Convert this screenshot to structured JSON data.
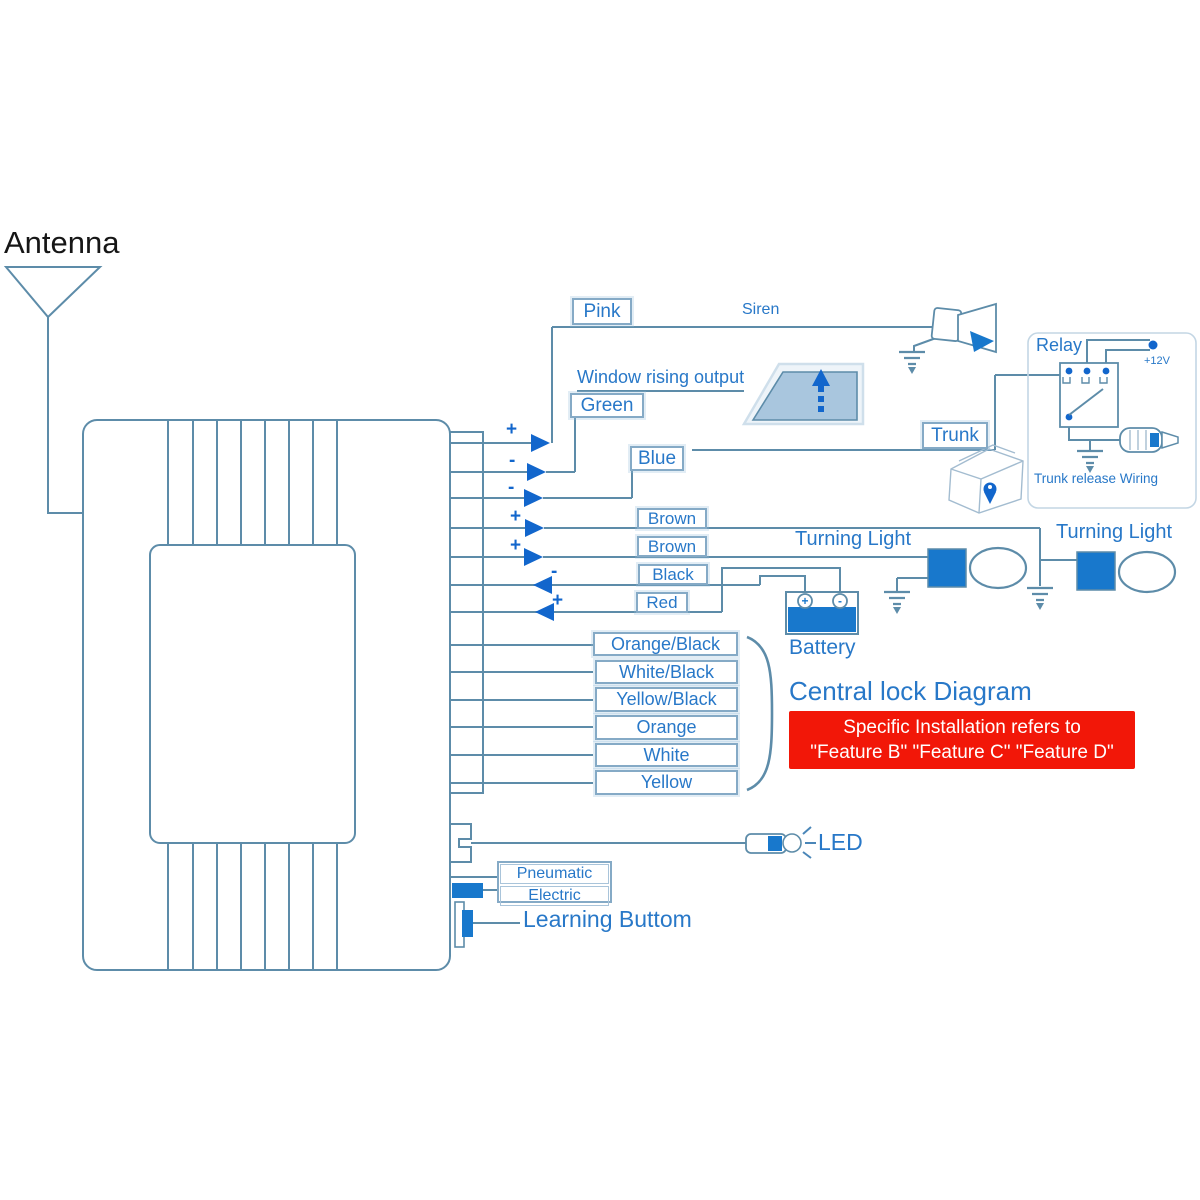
{
  "title": "Car alarm central lock wiring diagram",
  "colors": {
    "wire": "#5d8ca9",
    "label_border": "#85aac6",
    "label_text": "#2878c8",
    "arrow_blue": "#1266cc",
    "component_blue": "#1878cc",
    "warning_bg": "#f21708",
    "warning_text": "#ffffff",
    "antenna_text": "#161616"
  },
  "antenna_label": "Antenna",
  "wires": [
    {
      "label": "Pink",
      "sign": "+"
    },
    {
      "label": "Green",
      "sign": "-"
    },
    {
      "label": "Blue",
      "sign": "-"
    },
    {
      "label": "Brown",
      "sign": "+"
    },
    {
      "label": "Brown",
      "sign": "+"
    },
    {
      "label": "Black",
      "sign": "-"
    },
    {
      "label": "Red",
      "sign": "+"
    },
    {
      "label": "Orange/Black"
    },
    {
      "label": "White/Black"
    },
    {
      "label": "Yellow/Black"
    },
    {
      "label": "Orange"
    },
    {
      "label": "White"
    },
    {
      "label": "Yellow"
    }
  ],
  "annotations": {
    "siren": "Siren",
    "window_rising_output": "Window rising output",
    "trunk": "Trunk",
    "relay": "Relay",
    "supply": "+12V",
    "trunk_release": "Trunk release Wiring",
    "turning_light_left": "Turning Light",
    "turning_light_right": "Turning Light",
    "battery": "Battery",
    "battery_plus": "+",
    "battery_minus": "-",
    "central_lock_title": "Central lock Diagram",
    "led": "LED",
    "pneumatic": "Pneumatic",
    "electric": "Electric",
    "learning_button": "Learning Buttom"
  },
  "warning": {
    "line1": "Specific Installation refers to",
    "line2": "\"Feature B\" \"Feature C\" \"Feature D\""
  }
}
